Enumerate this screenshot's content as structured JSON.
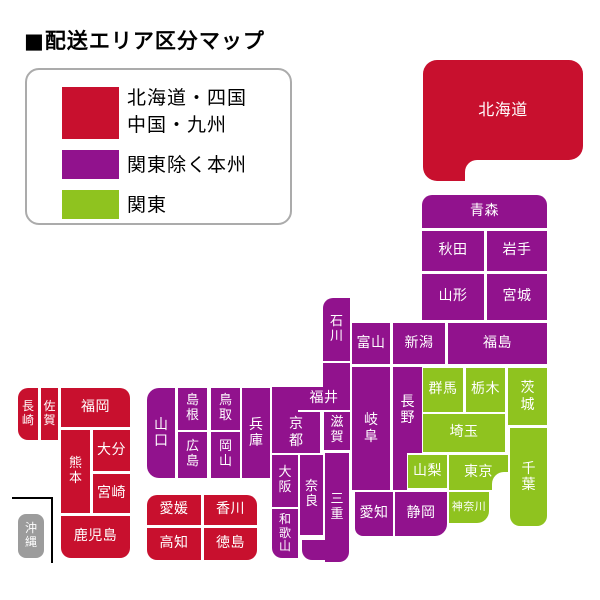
{
  "title": "■配送エリア区分マップ",
  "legend": {
    "items": [
      {
        "label": "北海道・四国\n中国・九州",
        "area": "red"
      },
      {
        "label": "関東除く本州",
        "area": "purple"
      },
      {
        "label": "関東",
        "area": "green"
      }
    ]
  },
  "areas": {
    "red": "#C8102E",
    "purple": "#91128D",
    "green": "#8FC31F",
    "gray": "#9C9C9C"
  },
  "map": {
    "labels": {
      "hokkaido": "北海道",
      "aomori": "青森",
      "akita": "秋田",
      "iwate": "岩手",
      "yamagata": "山形",
      "miyagi": "宮城",
      "fukushima": "福島",
      "niigata": "新潟",
      "toyama": "富山",
      "ishikawa": "石川",
      "fukui": "福井",
      "nagano": "長野",
      "gifu": "岐阜",
      "gunma": "群馬",
      "tochigi": "栃木",
      "ibaraki": "茨城",
      "saitama": "埼玉",
      "yamanashi": "山梨",
      "tokyo": "東京",
      "chiba": "千葉",
      "kanagawa": "神奈川",
      "shizuoka": "静岡",
      "aichi": "愛知",
      "mie": "三重",
      "shiga": "滋賀",
      "kyoto": "京都",
      "nara": "奈良",
      "osaka": "大阪",
      "wakayama": "和歌山",
      "hyogo": "兵庫",
      "tottori": "鳥取",
      "shimane": "島根",
      "okayama": "岡山",
      "hiroshima": "広島",
      "yamaguchi": "山口",
      "ehime": "愛媛",
      "kagawa": "香川",
      "kochi": "高知",
      "tokushima": "徳島",
      "fukuoka": "福岡",
      "saga": "佐賀",
      "nagasaki": "長崎",
      "kumamoto": "熊本",
      "oita": "大分",
      "miyazaki": "宮崎",
      "kagoshima": "鹿児島",
      "okinawa": "沖縄"
    }
  }
}
